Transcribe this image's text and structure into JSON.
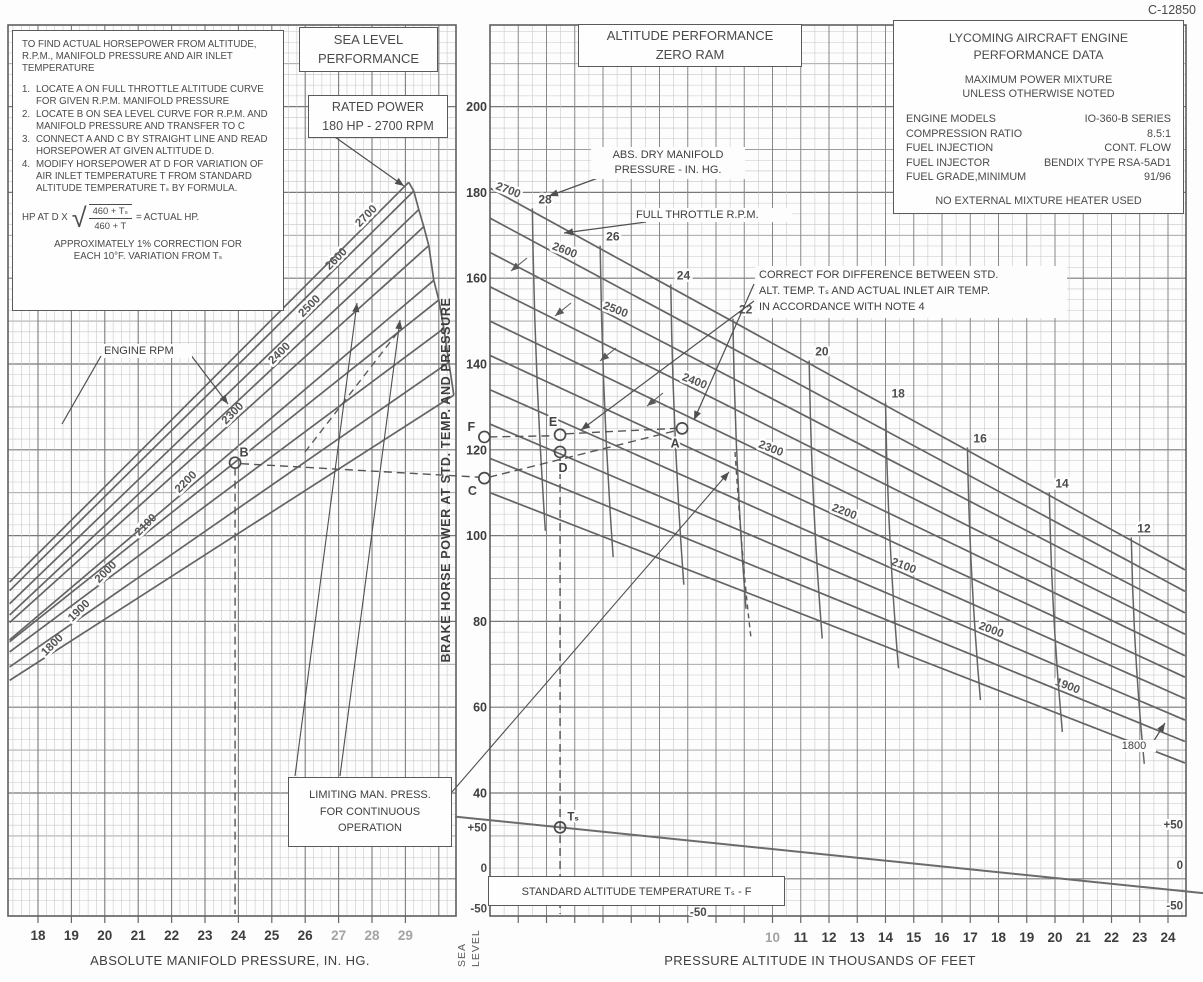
{
  "doc_number": "C-12850",
  "instructions": {
    "intro": "TO FIND ACTUAL HORSEPOWER FROM ALTITUDE, R.P.M., MANIFOLD PRESSURE AND AIR INLET TEMPERATURE",
    "steps": [
      {
        "num": "1.",
        "text": "LOCATE A ON FULL THROTTLE ALTITUDE CURVE FOR GIVEN R.P.M. MANIFOLD PRESSURE"
      },
      {
        "num": "2.",
        "text": "LOCATE B ON SEA LEVEL CURVE FOR R.P.M. AND MANIFOLD PRESSURE AND TRANSFER TO C"
      },
      {
        "num": "3.",
        "text": "CONNECT A AND C BY STRAIGHT LINE AND READ HORSEPOWER AT GIVEN ALTITUDE D."
      },
      {
        "num": "4.",
        "text": "MODIFY HORSEPOWER AT D FOR VARIATION OF AIR INLET TEMPERATURE T FROM STANDARD ALTITUDE TEMPERATURE Tₛ BY FORMULA."
      }
    ],
    "formula": {
      "prefix": "HP AT D X",
      "numerator": "460 + Tₛ",
      "denominator": "460 + T",
      "suffix": "= ACTUAL HP."
    },
    "note_line1": "APPROXIMATELY 1% CORRECTION FOR",
    "note_line2": "EACH 10°F. VARIATION FROM Tₛ"
  },
  "left_titles": {
    "sea_level_1": "SEA LEVEL",
    "sea_level_2": "PERFORMANCE",
    "rated_1": "RATED POWER",
    "rated_2": "180 HP - 2700 RPM"
  },
  "right_titles": {
    "alt_1": "ALTITUDE PERFORMANCE",
    "alt_2": "ZERO RAM"
  },
  "engine_data": {
    "title1": "LYCOMING AIRCRAFT ENGINE",
    "title2": "PERFORMANCE DATA",
    "sub1": "MAXIMUM POWER MIXTURE",
    "sub2": "UNLESS OTHERWISE NOTED",
    "specs": [
      {
        "label": "ENGINE MODELS",
        "value": "IO-360-B SERIES"
      },
      {
        "label": "COMPRESSION RATIO",
        "value": "8.5:1"
      },
      {
        "label": "FUEL INJECTION",
        "value": "CONT. FLOW"
      },
      {
        "label": "FUEL INJECTOR",
        "value": "BENDIX TYPE RSA-5AD1"
      },
      {
        "label": "FUEL GRADE,MINIMUM",
        "value": "91/96"
      }
    ],
    "footer": "NO EXTERNAL MIXTURE HEATER USED"
  },
  "annotations": {
    "abs_dry_1": "ABS. DRY MANIFOLD",
    "abs_dry_2": "PRESSURE - IN. HG.",
    "full_throttle": "FULL THROTTLE R.P.M.",
    "engine_rpm": "ENGINE RPM",
    "correct_1": "CORRECT FOR DIFFERENCE BETWEEN STD.",
    "correct_2": "ALT. TEMP. Tₛ AND ACTUAL INLET AIR TEMP.",
    "correct_3": "IN ACCORDANCE WITH NOTE 4",
    "limiting_1": "LIMITING MAN. PRESS.",
    "limiting_2": "FOR CONTINUOUS",
    "limiting_3": "OPERATION",
    "std_alt_temp": "STANDARD ALTITUDE TEMPERATURE  Tₛ  -  F",
    "cut_curve_label": "1800",
    "ts_point_label": "Tₛ"
  },
  "axis_titles": {
    "left_x": "ABSOLUTE MANIFOLD PRESSURE, IN. HG.",
    "right_x": "PRESSURE ALTITUDE IN THOUSANDS OF FEET",
    "shared_y": "BRAKE  HORSE  POWER  AT  STD.  TEMP.  AND  PRESSURE",
    "sea_level_vert_1": "SEA",
    "sea_level_vert_2": "LEVEL"
  },
  "chart_data": [
    {
      "type": "line",
      "title": "SEA LEVEL PERFORMANCE",
      "xlabel": "ABSOLUTE MANIFOLD PRESSURE, IN. HG.",
      "ylabel": "BRAKE HORSE POWER AT STD. TEMP. AND PRESSURE",
      "xlim_in_hg": [
        17.1,
        30.5
      ],
      "x_ticks": [
        18,
        19,
        20,
        21,
        22,
        23,
        24,
        25,
        26,
        27,
        28,
        29
      ],
      "x_ticks_gray": [
        27,
        28,
        29
      ],
      "rated_power_hp": 180,
      "rated_rpm": 2700,
      "mp_start": 17.15,
      "series": [
        {
          "rpm": 1800,
          "label_mp": 18.5,
          "hp_at_label": 73,
          "hp_per_inhg": 5.0,
          "mp_end": 30.45
        },
        {
          "rpm": 1900,
          "label_mp": 19.3,
          "hp_at_label": 81,
          "hp_per_inhg": 5.4,
          "mp_end": 30.3
        },
        {
          "rpm": 2000,
          "label_mp": 20.1,
          "hp_at_label": 90,
          "hp_per_inhg": 5.8,
          "mp_end": 30.15
        },
        {
          "rpm": 2100,
          "label_mp": 21.3,
          "hp_at_label": 101,
          "hp_per_inhg": 6.2,
          "mp_end": 30.0
        },
        {
          "rpm": 2200,
          "label_mp": 22.5,
          "hp_at_label": 111,
          "hp_per_inhg": 6.6,
          "mp_end": 29.85
        },
        {
          "rpm": 2300,
          "label_mp": 23.9,
          "hp_at_label": 127,
          "hp_per_inhg": 7.0,
          "mp_end": 29.7
        },
        {
          "rpm": 2400,
          "label_mp": 25.3,
          "hp_at_label": 141,
          "hp_per_inhg": 7.3,
          "mp_end": 29.55
        },
        {
          "rpm": 2500,
          "label_mp": 26.2,
          "hp_at_label": 152,
          "hp_per_inhg": 7.5,
          "mp_end": 29.4
        },
        {
          "rpm": 2600,
          "label_mp": 27.0,
          "hp_at_label": 163,
          "hp_per_inhg": 7.7,
          "mp_end": 29.25
        },
        {
          "rpm": 2700,
          "label_mp": 27.9,
          "hp_at_label": 173,
          "hp_per_inhg": 7.8,
          "mp_end": 29.1
        }
      ],
      "example_point": {
        "label": "B",
        "mp": 23.9,
        "hp": 117
      },
      "dashed_vertical_mp": 23.9
    },
    {
      "type": "line",
      "title": "ALTITUDE PERFORMANCE ZERO RAM",
      "xlabel": "PRESSURE ALTITUDE IN THOUSANDS OF FEET",
      "ylabel": "BRAKE HORSE POWER AT STD. TEMP. AND PRESSURE",
      "alt_range_kft": [
        0,
        24.6
      ],
      "x_ticks": [
        10,
        11,
        12,
        13,
        14,
        15,
        16,
        17,
        18,
        19,
        20,
        21,
        22,
        23,
        24
      ],
      "x_ticks_gray": [
        10
      ],
      "y_ticks_hp": [
        200,
        180,
        160,
        140,
        120,
        100,
        80,
        60,
        40
      ],
      "series": [
        {
          "rpm": 2700,
          "hp_sea_level": 181,
          "hp_at_24600ft": 92,
          "label_alt": 0.6
        },
        {
          "rpm": 2600,
          "hp_sea_level": 174,
          "hp_at_24600ft": 87,
          "label_alt": 2.6
        },
        {
          "rpm": 2500,
          "hp_sea_level": 166,
          "hp_at_24600ft": 82,
          "label_alt": 4.4
        },
        {
          "rpm": 2400,
          "hp_sea_level": 158,
          "hp_at_24600ft": 77,
          "label_alt": 7.2
        },
        {
          "rpm": 2300,
          "hp_sea_level": 150,
          "hp_at_24600ft": 72,
          "label_alt": 9.9
        },
        {
          "rpm": 2200,
          "hp_sea_level": 142,
          "hp_at_24600ft": 67,
          "label_alt": 12.5
        },
        {
          "rpm": 2100,
          "hp_sea_level": 134,
          "hp_at_24600ft": 62,
          "label_alt": 14.6
        },
        {
          "rpm": 2000,
          "hp_sea_level": 126,
          "hp_at_24600ft": 57,
          "label_alt": 17.7
        },
        {
          "rpm": 1900,
          "hp_sea_level": 118,
          "hp_at_24600ft": 52,
          "label_alt": 20.4
        },
        {
          "rpm": 1800,
          "hp_sea_level": 110,
          "hp_at_24600ft": 47,
          "label_alt": -1
        }
      ],
      "manifold_pressure_lines": [
        {
          "in_hg": 28,
          "alt_kft": 1.5
        },
        {
          "in_hg": 26,
          "alt_kft": 3.9
        },
        {
          "in_hg": 24,
          "alt_kft": 6.4
        },
        {
          "in_hg": 22,
          "alt_kft": 8.6
        },
        {
          "in_hg": 20,
          "alt_kft": 11.3
        },
        {
          "in_hg": 18,
          "alt_kft": 14.0
        },
        {
          "in_hg": 16,
          "alt_kft": 16.9
        },
        {
          "in_hg": 14,
          "alt_kft": 19.8
        },
        {
          "in_hg": 12,
          "alt_kft": 22.7
        }
      ],
      "example_points": [
        {
          "label": "A",
          "alt": 6.8,
          "hp": 125,
          "dx": -7,
          "dy": 19
        },
        {
          "label": "C",
          "alt": -0.2,
          "hp": 113.4,
          "dx": -12,
          "dy": 17
        },
        {
          "label": "D",
          "alt": 2.48,
          "hp": 119.5,
          "dx": 3,
          "dy": 20
        },
        {
          "label": "E",
          "alt": 2.48,
          "hp": 123.5,
          "dx": -7,
          "dy": -9
        },
        {
          "label": "F",
          "alt": -0.2,
          "hp": 123,
          "dx": -13,
          "dy": -6
        }
      ],
      "std_temp_line": {
        "temp_at_sea_level_f": 59,
        "lapse_f_per_1000ft": 3.566
      },
      "temp_ticks": [
        {
          "label": "+50",
          "t": 50
        },
        {
          "label": "0",
          "t": 0
        },
        {
          "label": "-50",
          "t": -50
        }
      ],
      "temp_mid_label": "-50"
    }
  ]
}
